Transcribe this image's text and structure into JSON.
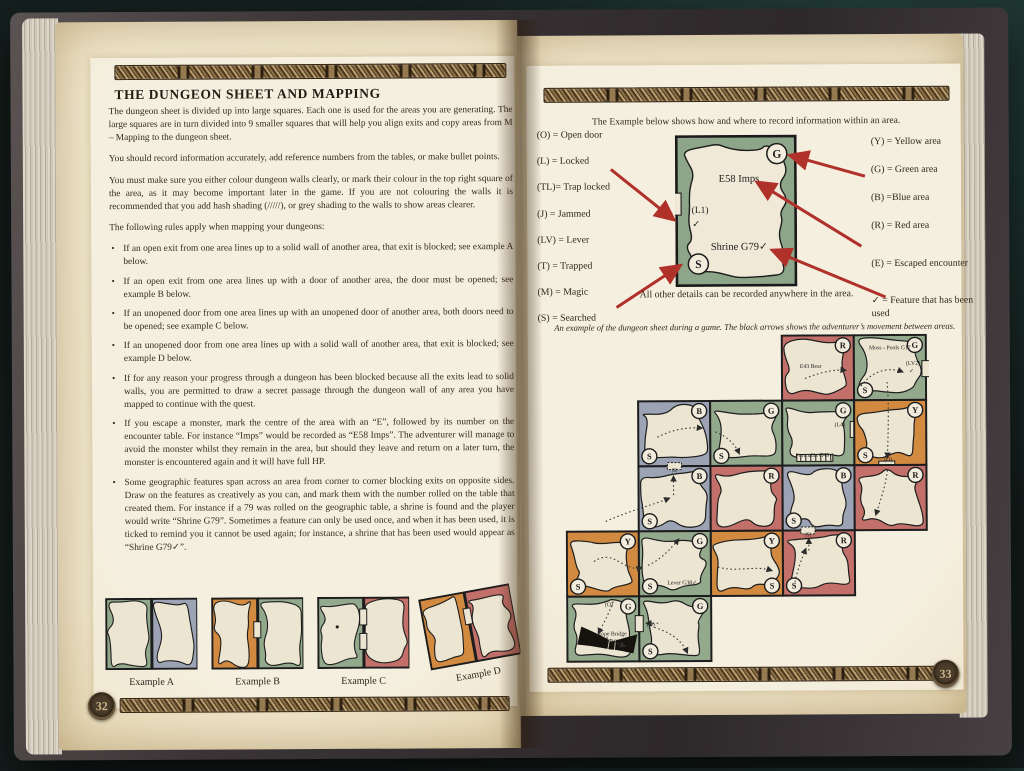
{
  "left_page": {
    "page_number": "32",
    "title": "THE DUNGEON SHEET AND MAPPING",
    "paragraphs": [
      "The dungeon sheet is divided up into large squares. Each one is used for the areas you are generating. The large squares are in turn divided into 9 smaller squares that will help you align exits and copy areas from M – Mapping to the dungeon sheet.",
      "You should record information accurately, add reference numbers from the tables, or make bullet points.",
      "You must make sure you either colour dungeon walls clearly, or mark their colour in the top right square of the area, as it may become important later in the game. If you are not colouring the walls it is recommended that you add hash shading (/////), or grey shading to the walls to show areas clearer."
    ],
    "rules_intro": "The following rules apply when mapping your dungeons:",
    "bullets": [
      "If an open exit from one area lines up to a solid wall of another area, that exit is blocked; see example A below.",
      "If an open exit from one area lines up with a door of another area, the door must be opened; see example B below.",
      "If an unopened door from one area lines up with an unopened door of another area, both doors need to be opened; see example C below.",
      "If an unopened door from one area lines up with a solid wall of another area, that exit is blocked; see example D below.",
      "If for any reason your progress through a dungeon has been blocked because all the exits lead to solid walls, you are permitted to draw a secret passage through the dungeon wall of any area you have mapped to continue with the quest.",
      "If you escape a monster, mark the centre of the area with an “E”, followed by its number on the encounter table. For instance “Imps” would be recorded as “E58 Imps”. The adventurer will manage to avoid the monster whilst they remain in the area, but should they leave and return on a later turn, the monster is encountered again and it will have full HP.",
      "Some geographic features span across an area from corner to corner blocking exits on opposite sides. Draw on the features as creatively as you can, and mark them with the number rolled on the table that created them. For instance if a 79 was rolled on the geographic table, a shrine is found and the player would write “Shrine G79”. Sometimes a feature can only be used once, and when it has been used, it is ticked to remind you it cannot be used again; for instance, a shrine that has been used would appear as “Shrine G79✓”."
    ],
    "examples": [
      {
        "label": "Example A",
        "colors": [
          "green",
          "blue"
        ],
        "doors": []
      },
      {
        "label": "Example B",
        "colors": [
          "orange",
          "green"
        ],
        "doors": [
          0.45
        ]
      },
      {
        "label": "Example C",
        "colors": [
          "green",
          "red"
        ],
        "doors": [
          0.28,
          0.62
        ],
        "dot": true
      },
      {
        "label": "Example D",
        "colors": [
          "orange",
          "red"
        ],
        "doors": [
          0.35
        ]
      }
    ]
  },
  "right_page": {
    "page_number": "33",
    "intro": "The Example below shows how and where to record information within an area.",
    "legend_left": [
      "(O) = Open door",
      "(L) = Locked",
      "(TL)= Trap locked",
      "(J) = Jammed",
      "(LV) = Lever",
      "(T) = Trapped",
      "(M) = Magic",
      "(S) = Searched"
    ],
    "legend_right": [
      "(Y) = Yellow area",
      "(G) = Green area",
      "(B) =Blue area",
      "(R) = Red area",
      "(E) = Escaped encounter",
      "✓ = Feature that has been used"
    ],
    "example_area": {
      "monster": "E58 Imps",
      "door_label": "(L1)",
      "door_check": "✓",
      "feature": "Shrine G79✓",
      "corner_marker": "G",
      "searched_marker": "S",
      "caption": "All other details can be recorded anywhere in the area."
    },
    "map_caption": "An example of the dungeon sheet during a game. The black arrows shows the adventurer’s movement between areas.",
    "map": {
      "cells": [
        {
          "r": 1,
          "c": 4,
          "color": "red",
          "corner": "R",
          "labels": [
            {
              "t": "E43 Bear",
              "x": 0.4,
              "y": 0.5
            }
          ]
        },
        {
          "r": 1,
          "c": 5,
          "color": "green",
          "corner": "G",
          "s": [
            "bl"
          ],
          "labels": [
            {
              "t": "Moss - Pools G17",
              "x": 0.5,
              "y": 0.22
            },
            {
              "t": "(LV2)",
              "x": 0.82,
              "y": 0.46
            },
            {
              "t": "✓",
              "x": 0.8,
              "y": 0.58
            }
          ],
          "doors": [
            {
              "edge": "right",
              "pos": 0.52
            }
          ]
        },
        {
          "r": 2,
          "c": 2,
          "color": "blue",
          "corner": "B",
          "s": [
            "bl"
          ]
        },
        {
          "r": 2,
          "c": 3,
          "color": "green",
          "corner": "G",
          "s": [
            "bl"
          ]
        },
        {
          "r": 2,
          "c": 4,
          "color": "green",
          "corner": "G",
          "labels": [
            {
              "t": "(L4)",
              "x": 0.8,
              "y": 0.4
            },
            {
              "t": "Portcullis G49✓",
              "x": 0.45,
              "y": 0.87
            }
          ],
          "doors": [
            {
              "edge": "right",
              "pos": 0.45
            }
          ],
          "feature": "portcullis"
        },
        {
          "r": 2,
          "c": 5,
          "color": "orange",
          "corner": "Y",
          "s": [
            "bl"
          ],
          "labels": [
            {
              "t": "(O)",
              "x": 0.47,
              "y": 0.94
            }
          ],
          "doors": [
            {
              "edge": "bottom",
              "pos": 0.45
            }
          ]
        },
        {
          "r": 3,
          "c": 2,
          "color": "blue",
          "corner": "B",
          "s": [
            "bl"
          ],
          "labels": [
            {
              "t": "|S|",
              "x": 0.5,
              "y": 0.09
            }
          ],
          "doors": [
            {
              "edge": "top",
              "pos": 0.5,
              "secret": true
            }
          ]
        },
        {
          "r": 3,
          "c": 3,
          "color": "red",
          "corner": "R"
        },
        {
          "r": 3,
          "c": 4,
          "color": "blue",
          "corner": "B",
          "s": [
            "bl"
          ]
        },
        {
          "r": 3,
          "c": 5,
          "color": "red",
          "corner": "R"
        },
        {
          "r": 4,
          "c": 1,
          "color": "orange",
          "corner": "Y",
          "s": [
            "bl"
          ]
        },
        {
          "r": 4,
          "c": 2,
          "color": "green",
          "corner": "G",
          "s": [
            "bl"
          ],
          "labels": [
            {
              "t": "Lever G38✓",
              "x": 0.6,
              "y": 0.82
            }
          ]
        },
        {
          "r": 4,
          "c": 3,
          "color": "orange",
          "corner": "Y",
          "s": [
            "br"
          ]
        },
        {
          "r": 4,
          "c": 4,
          "color": "red",
          "corner": "R",
          "s": [
            "bl"
          ],
          "labels": [
            {
              "t": "|S|",
              "x": 0.35,
              "y": 0.09
            }
          ],
          "doors": [
            {
              "edge": "top",
              "pos": 0.35,
              "secret": true
            }
          ]
        },
        {
          "r": 5,
          "c": 1,
          "color": "green",
          "corner": "G",
          "labels": [
            {
              "t": "(O)",
              "x": 0.58,
              "y": 0.15
            },
            {
              "t": "Rope Bridge",
              "x": 0.62,
              "y": 0.6
            },
            {
              "t": "G18",
              "x": 0.62,
              "y": 0.72
            }
          ],
          "feature": "ropebridge"
        },
        {
          "r": 5,
          "c": 2,
          "color": "green",
          "corner": "G",
          "s": [
            "bl"
          ],
          "labels": [
            {
              "t": "(O)",
              "x": 0.16,
              "y": 0.46
            }
          ],
          "doors": [
            {
              "edge": "left",
              "pos": 0.42
            }
          ]
        }
      ]
    }
  },
  "colors": {
    "arrow_red": "#b0302a",
    "map": {
      "red": "#c4706a",
      "green": "#93a98c",
      "blue": "#9ba3b4",
      "orange": "#d28a41",
      "floor": "#ece5d1",
      "outline": "#1d1d1d"
    }
  }
}
